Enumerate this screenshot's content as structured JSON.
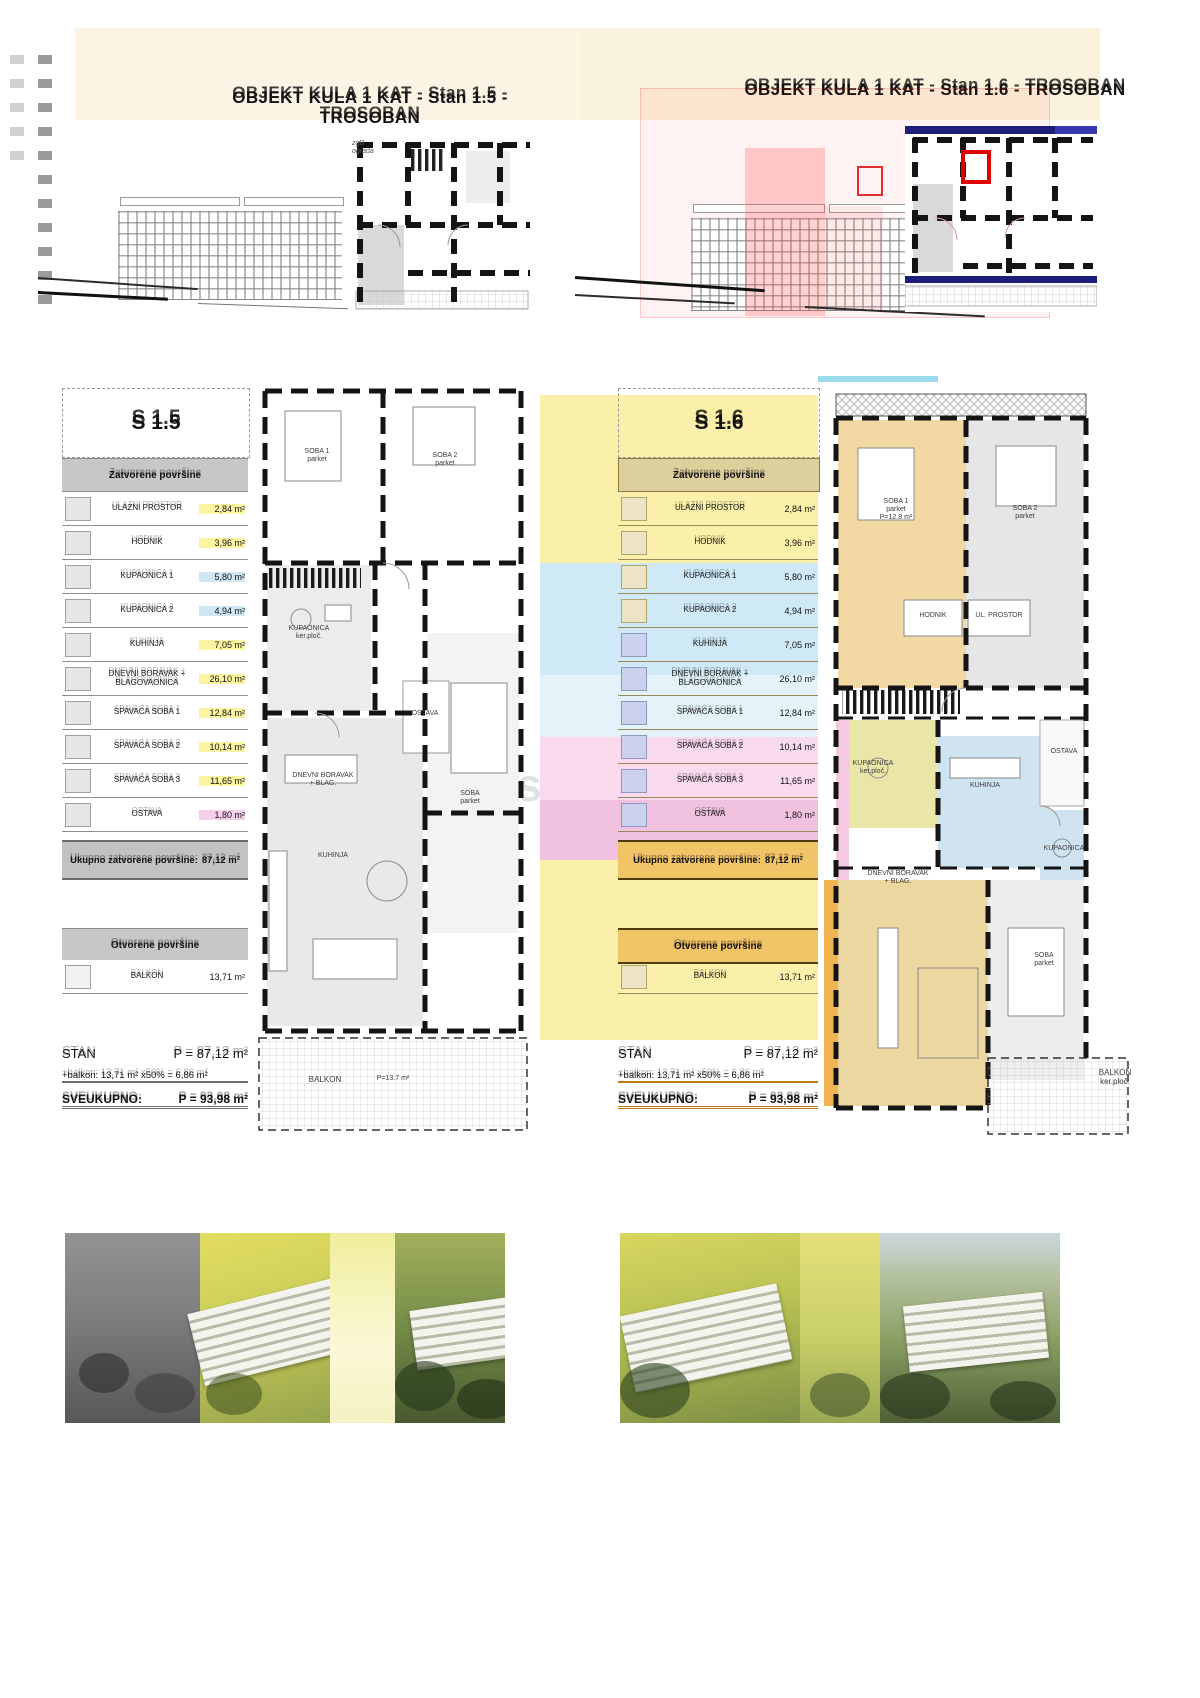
{
  "header": {
    "title_left": "OBJEKT KULA 1 KAT - Stan 1.5 - TROSOBAN",
    "title_right": "OBJEKT KULA 1 KAT - Stan 1.6 - TROSOBAN"
  },
  "key_plan_note": "zgB\nograda",
  "watermark": "als",
  "left_unit": {
    "id": "S 1.5",
    "closed_header": "Zatvorene površine",
    "rows": [
      {
        "label": "ULAZNI PROSTOR",
        "value": "2,84 m²"
      },
      {
        "label": "HODNIK",
        "value": "3,96 m²"
      },
      {
        "label": "KUPAONICA 1",
        "value": "5,80 m²"
      },
      {
        "label": "KUPAONICA 2",
        "value": "4,94 m²"
      },
      {
        "label": "KUHINJA",
        "value": "7,05 m²"
      },
      {
        "label": "DNEVNI BORAVAK + BLAGOVAONICA",
        "value": "26,10 m²"
      },
      {
        "label": "SPAVAĆA SOBA 1",
        "value": "12,84 m²"
      },
      {
        "label": "SPAVAĆA SOBA 2",
        "value": "10,14 m²"
      },
      {
        "label": "SPAVAĆA SOBA 3",
        "value": "11,65 m²"
      },
      {
        "label": "OSTAVA",
        "value": "1,80 m²"
      }
    ],
    "total_label": "Ukupno zatvorene površine:",
    "total_value": "87,12 m²",
    "open_header": "Otvorene površine",
    "open_rows": [
      {
        "label": "BALKON",
        "value": "13,71 m²"
      }
    ],
    "summary": {
      "stan_label": "STAN",
      "stan_value": "P = 87,12 m²",
      "balkon_line": "+balkon: 13,71 m² x50% = 6,86 m²",
      "total_label": "SVEUKUPNO:",
      "total_value": "P = 93,98 m²"
    }
  },
  "right_unit": {
    "id": "S 1.6",
    "closed_header": "Zatvorene površine",
    "rows": [
      {
        "label": "ULAZNI PROSTOR",
        "value": "2,84 m²"
      },
      {
        "label": "HODNIK",
        "value": "3,96 m²"
      },
      {
        "label": "KUPAONICA 1",
        "value": "5,80 m²"
      },
      {
        "label": "KUPAONICA 2",
        "value": "4,94 m²"
      },
      {
        "label": "KUHINJA",
        "value": "7,05 m²"
      },
      {
        "label": "DNEVNI BORAVAK + BLAGOVAONICA",
        "value": "26,10 m²"
      },
      {
        "label": "SPAVAĆA SOBA 1",
        "value": "12,84 m²"
      },
      {
        "label": "SPAVAĆA SOBA 2",
        "value": "10,14 m²"
      },
      {
        "label": "SPAVAĆA SOBA 3",
        "value": "11,65 m²"
      },
      {
        "label": "OSTAVA",
        "value": "1,80 m²"
      }
    ],
    "total_label": "Ukupno zatvorene površine:",
    "total_value": "87,12 m²",
    "open_header": "Otvorene površine",
    "open_rows": [
      {
        "label": "BALKON",
        "value": "13,71 m²"
      }
    ],
    "summary": {
      "stan_label": "STAN",
      "stan_value": "P = 87,12 m²",
      "balkon_line": "+balkon: 13,71 m² x50% = 6,86 m²",
      "total_label": "SVEUKUPNO:",
      "total_value": "P = 93,98 m²"
    }
  },
  "plan_left": {
    "soba1": "SOBA 1\nparket",
    "soba2": "SOBA 2\nparket",
    "kupaonica": "KUPAONICA\nker.ploč.",
    "ostava": "OSTAVA",
    "kuhinja": "KUHINJA",
    "soba3": "SOBA\nparket",
    "dnevni": "DNEVNI BORAVAK\n+ BLAG.",
    "balkon": "BALKON",
    "balkon_area": "P=13.7 m²"
  },
  "plan_right": {
    "soba1": "SOBA 1\nparket\nP=12.8 m²",
    "soba2": "SOBA 2\nparket",
    "kupaonica": "KUPAONICA\nker.ploč.",
    "kuhinja": "KUHINJA",
    "ostava": "OSTAVA",
    "hodnik": "HODNIK",
    "ulaz": "UL. PROSTOR",
    "kupaonica2": "KUPAONICA",
    "dnevni": "DNEVNI BORAVAK\n+ BLAG.",
    "soba3": "SOBA\nparket",
    "balkon": "BALKON\nker.ploč."
  }
}
